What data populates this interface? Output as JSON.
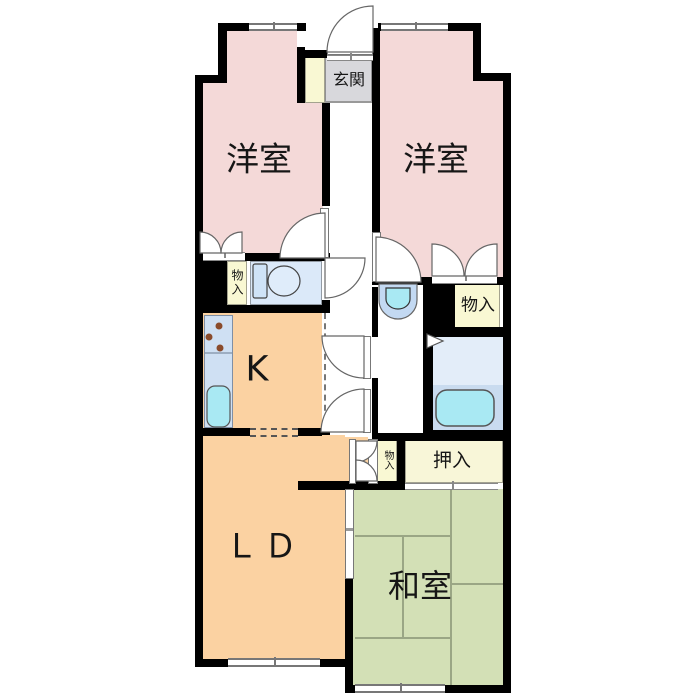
{
  "plan": {
    "type": "apartment-floor-plan",
    "rooms": {
      "genkan": "玄関",
      "western_room_left": "洋室",
      "western_room_right": "洋室",
      "kitchen": "K",
      "living_dining": "ＬＤ",
      "japanese_room": "和室",
      "storage_left": "物入",
      "storage_right": "物入",
      "storage_small": "物入",
      "oshiire_closet": "押入"
    },
    "colors": {
      "wall": "#000000",
      "western_room": "#f4d9d8",
      "wood_floor": "#fbd2a2",
      "tatami": "#d3e0b6",
      "storage": "#f9f8d3",
      "oshiire": "#f8f6d8",
      "genkan": "#d8d8dc",
      "toilet_floor": "#dbe9f9",
      "bath_floor_upper": "#e3edf9",
      "bath_floor_lower": "#c9dbef",
      "counter": "#cfe0f3",
      "fixture_cyan": "#a9e9f3",
      "toilet_tank": "#cfe3f7",
      "toilet_bowl": "#dfecfa",
      "basin_outer": "#c3d9f2",
      "tatami_line": "#9aa685",
      "hall": "#ffffff",
      "burner": "#8a4b2b"
    }
  }
}
